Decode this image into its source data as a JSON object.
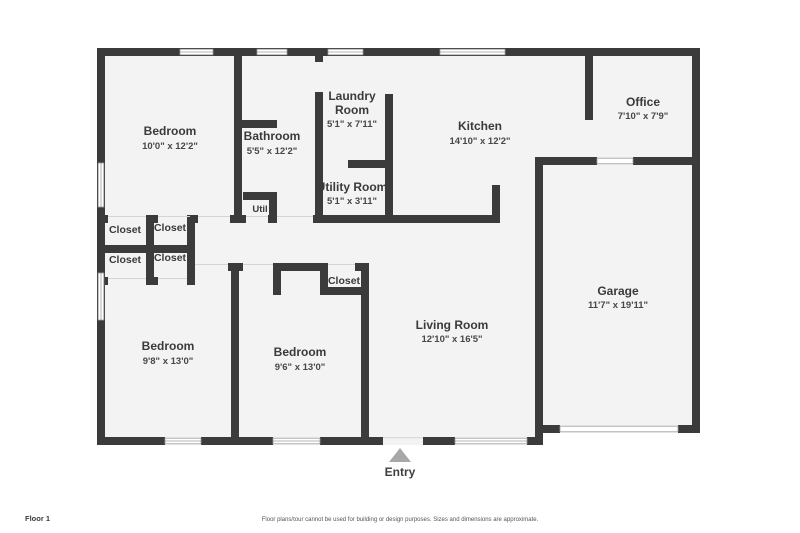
{
  "rooms": {
    "bedroom_tl": {
      "name": "Bedroom",
      "dims": "10'0\" x 12'2\""
    },
    "bathroom": {
      "name": "Bathroom",
      "dims": "5'5\" x 12'2\""
    },
    "laundry": {
      "name_line1": "Laundry",
      "name_line2": "Room",
      "dims": "5'1\" x 7'11\""
    },
    "utility": {
      "name": "Utility Room",
      "dims": "5'1\" x 3'11\""
    },
    "kitchen": {
      "name": "Kitchen",
      "dims": "14'10\" x 12'2\""
    },
    "office": {
      "name": "Office",
      "dims": "7'10\" x 7'9\""
    },
    "garage": {
      "name": "Garage",
      "dims": "11'7\" x 19'11\""
    },
    "living": {
      "name": "Living Room",
      "dims": "12'10\" x 16'5\""
    },
    "bedroom_bl": {
      "name": "Bedroom",
      "dims": "9'8\" x 13'0\""
    },
    "bedroom_bm": {
      "name": "Bedroom",
      "dims": "9'6\" x 13'0\""
    }
  },
  "labels": {
    "closet": "Closet",
    "util": "Util",
    "entry": "Entry"
  },
  "footer": {
    "floor_label": "Floor 1",
    "disclaimer": "Floor plans/tour cannot be used for building or design purposes. Sizes and dimensions are approximate."
  },
  "colors": {
    "wall": "#3b3b3b",
    "room_fill": "#f3f3f3",
    "background": "#ffffff",
    "entry_arrow": "#a8a8a8",
    "label_text": "#3a3a3a"
  }
}
